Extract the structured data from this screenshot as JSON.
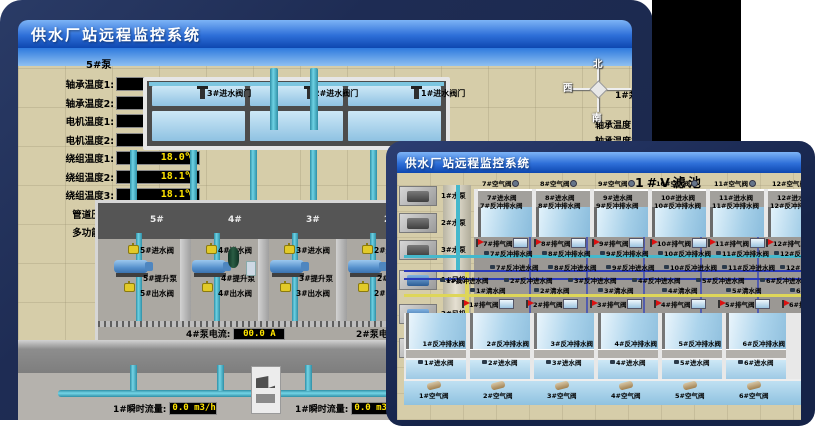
{
  "colors": {
    "backdrop": "#1e2c54",
    "black_patch": "#000000",
    "titlebar_top": "#7db4f6",
    "titlebar_bottom": "#0d47b0",
    "sand": "#d6cda9",
    "water": "#a5cfe8",
    "led_bg": "#000000",
    "led_text": "#ffe400",
    "pipe_cyan": "#45b8cc",
    "pipe_blue": "#2a3bbb",
    "pipe_yellow": "#ded659",
    "valve_yellow": "#e2ca28",
    "flag_red": "#dd1111"
  },
  "window1": {
    "title": "供水厂站远程监控系统",
    "scene_title": "取水泵房",
    "pump_panel": {
      "header": "5#泵",
      "rows": [
        {
          "label": "轴承温度1:",
          "value": "100.0℃"
        },
        {
          "label": "轴承温度2:",
          "value": "100.0℃"
        },
        {
          "label": "电机温度1:",
          "value": "18.1℃"
        },
        {
          "label": "电机温度2:",
          "value": "17.9℃"
        },
        {
          "label": "绕组温度1:",
          "value": "18.0℃"
        },
        {
          "label": "绕组温度2:",
          "value": "18.1℃"
        },
        {
          "label": "绕组温度3:",
          "value": "18.1℃"
        },
        {
          "label": "管道压力:",
          "value": "0.0007MPa"
        },
        {
          "label": "多功能阀:",
          "value": "0%"
        }
      ]
    },
    "pool_valves": [
      {
        "label": "3#进水阀门"
      },
      {
        "label": "2#进水阀门"
      },
      {
        "label": "1#进水阀门"
      }
    ],
    "compass": {
      "north": "北",
      "west": "西",
      "south": "南"
    },
    "right_panel": {
      "header": "1#泵",
      "rows": [
        {
          "label": "轴承温度1:"
        },
        {
          "label": "轴承温度2:"
        }
      ]
    },
    "pump_room": {
      "bays": [
        {
          "num": "5#",
          "inlet": "5#进水阀",
          "pump": "5#提升泵",
          "outlet": "5#出水阀"
        },
        {
          "num": "4#",
          "inlet": "4#进水阀",
          "pump": "4#提升泵",
          "outlet": "4#出水阀"
        },
        {
          "num": "3#",
          "inlet": "3#进水阀",
          "pump": "3#提升泵",
          "outlet": "3#出水阀"
        },
        {
          "num": "2#",
          "inlet": "2#进水阀",
          "pump": "2#提升泵",
          "outlet": "2#出水阀"
        }
      ],
      "current_displays": [
        {
          "label": "4#泵电流:",
          "value": "00.0 A"
        },
        {
          "label": "2#泵电流:",
          "value": ""
        }
      ]
    },
    "flow_displays": [
      {
        "label": "1#瞬时流量:",
        "value": "0.0 m3/h"
      },
      {
        "label": "1#瞬时流量:",
        "value": "0.0 m3/h"
      }
    ]
  },
  "window2": {
    "title": "供水厂站远程监控系统",
    "scene_title": "1#V滤池",
    "pumps": [
      "1#水泵",
      "2#水泵",
      "3#水泵"
    ],
    "blowers": [
      "1#风机",
      "2#风机",
      "3#风机"
    ],
    "top_cells": [
      {
        "air": "7#空气阀",
        "inlet": "7#进水阀",
        "bw_drain": "7#反冲排水阀",
        "bw_inlet": "7#反冲进水阀",
        "exhaust": "7#排气阀"
      },
      {
        "air": "8#空气阀",
        "inlet": "8#进水阀",
        "bw_drain": "8#反冲排水阀",
        "bw_inlet": "8#反冲进水阀",
        "exhaust": "8#排气阀"
      },
      {
        "air": "9#空气阀",
        "inlet": "9#进水阀",
        "bw_drain": "9#反冲排水阀",
        "bw_inlet": "9#反冲进水阀",
        "exhaust": "9#排气阀"
      },
      {
        "air": "10#空气阀",
        "inlet": "10#进水阀",
        "bw_drain": "10#反冲排水阀",
        "bw_inlet": "10#反冲进水阀",
        "exhaust": "10#排气阀"
      },
      {
        "air": "11#空气阀",
        "inlet": "11#进水阀",
        "bw_drain": "11#反冲排水阀",
        "bw_inlet": "11#反冲进水阀",
        "exhaust": "11#排气阀"
      },
      {
        "air": "12#空气阀",
        "inlet": "12#进水阀",
        "bw_drain": "12#反冲排水阀",
        "bw_inlet": "12#反冲进水阀",
        "exhaust": "12#排气阀"
      }
    ],
    "bottom_cells": [
      {
        "air": "1#空气阀",
        "inlet": "1#进水阀",
        "bw_drain": "1#反冲排水阀",
        "bw_inlet": "1#反冲进水阀",
        "exhaust": "1#排气阀",
        "clean": "1#清水阀"
      },
      {
        "air": "2#空气阀",
        "inlet": "2#进水阀",
        "bw_drain": "2#反冲排水阀",
        "bw_inlet": "2#反冲进水阀",
        "exhaust": "2#排气阀",
        "clean": "2#清水阀"
      },
      {
        "air": "3#空气阀",
        "inlet": "3#进水阀",
        "bw_drain": "3#反冲排水阀",
        "bw_inlet": "3#反冲进水阀",
        "exhaust": "3#排气阀",
        "clean": "3#清水阀"
      },
      {
        "air": "4#空气阀",
        "inlet": "4#进水阀",
        "bw_drain": "4#反冲排水阀",
        "bw_inlet": "4#反冲进水阀",
        "exhaust": "4#排气阀",
        "clean": "4#清水阀"
      },
      {
        "air": "5#空气阀",
        "inlet": "5#进水阀",
        "bw_drain": "5#反冲排水阀",
        "bw_inlet": "5#反冲进水阀",
        "exhaust": "5#排气阀",
        "clean": "5#清水阀"
      },
      {
        "air": "6#空气阀",
        "inlet": "6#进水阀",
        "bw_drain": "6#反冲排水阀",
        "bw_inlet": "6#反冲进水阀",
        "exhaust": "6#排气阀",
        "clean": "6#清水阀"
      }
    ]
  }
}
